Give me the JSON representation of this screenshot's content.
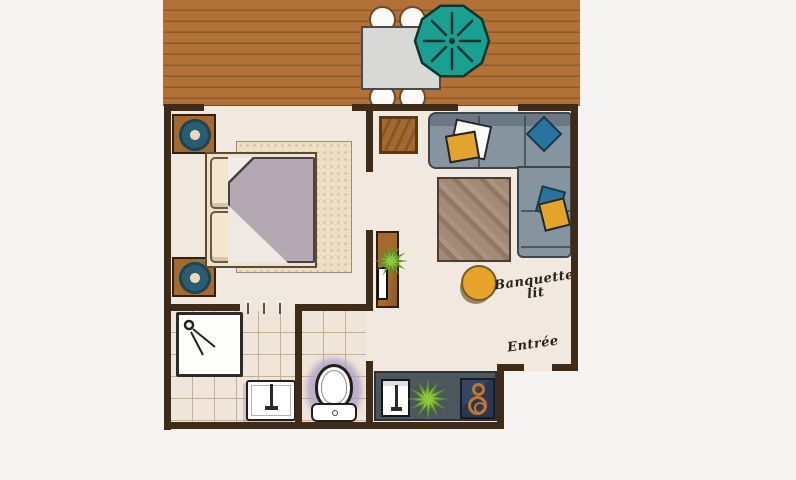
{
  "plan": {
    "labels": {
      "sofa_bed_line1": "Banquette",
      "sofa_bed_line2": "lit",
      "entrance": "Entrée"
    },
    "colors": {
      "background": "#f5f4f2",
      "deck": "#b17137",
      "deck_line": "#8a5a28",
      "wall": "#3e2b18",
      "floor": "#f1e8e0",
      "tile_line": "#c9ae90",
      "sofa": "#8694a0",
      "sofa_seam": "#3c464e",
      "cushion_yellow": "#e3a32c",
      "cushion_teal": "#28749c",
      "rug_living": "#a28a77",
      "rug_bedroom": "#ecdfc6",
      "duvet": "#b4a8b3",
      "cream": "#f4e7cf",
      "wood": "#a4692e",
      "speaker": "#2b5d72",
      "counter": "#4d555d",
      "cooktop": "#2b3950",
      "burner": "#c0762c",
      "parasol": "#1aa093",
      "pouf": "#e6a42b",
      "glow": "#b0a0c4",
      "plant_dark": "#5d9427",
      "plant_light": "#8fc63f",
      "table": "#d8d8d6",
      "ink": "#2a2119"
    },
    "furniture_icons": [
      "deck-table",
      "deck-chair",
      "parasol",
      "double-bed",
      "bed-pillow",
      "duvet",
      "nightstand",
      "speaker",
      "bedside-rug",
      "doormat",
      "corner-sofa",
      "cushion",
      "living-rug",
      "pouf",
      "tv-console",
      "tv",
      "potted-plant",
      "shower",
      "washbasin",
      "toilet",
      "kitchen-counter",
      "kitchen-sink",
      "cooktop"
    ]
  }
}
